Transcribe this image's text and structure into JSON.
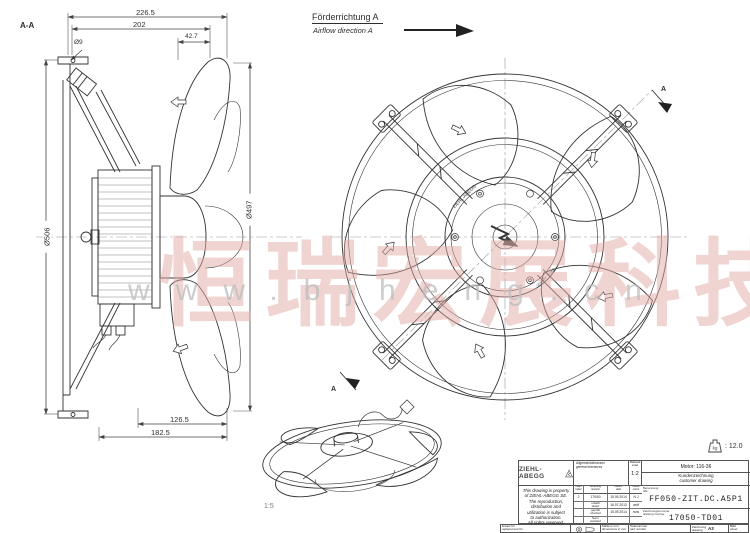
{
  "watermark": {
    "cn_text": "恒瑞宏展科技",
    "url_text": "www.bjheng.cn"
  },
  "annotations": {
    "section_label": "A-A",
    "airflow_de": "Förderrichtung A",
    "airflow_en": "Airflow direction A",
    "front_marker": "A",
    "iso_scale": "1:5",
    "hub_brand": "ZIEHL-ABEGG"
  },
  "dimensions": {
    "top_total": "226.5",
    "top_inner": "202",
    "top_small": "42.7",
    "hole": "Ø9",
    "outer_dia": "Ø506",
    "blade_dia": "Ø497",
    "bottom_inner": "126.5",
    "bottom_total": "182.5"
  },
  "titleblock": {
    "logo_text": "ZIEHL-ABEGG",
    "weight_text": ": 12.0",
    "weight_unit": "kg",
    "tolerances_de": "Allgemeintoleranzen",
    "tolerances_en": "general tolerances",
    "scale_de": "Maßstab",
    "scale_en": "scale",
    "scale_value": "1:2",
    "motor": "Motor: 116-36",
    "doc_type_de": "Kundenzeichnung",
    "doc_type_en": "customer drawing",
    "title_label_de": "Benennung",
    "title_label_en": "title",
    "part_name": "FF050-ZIT.DC.A5P1",
    "drawing_no_label_de": "Zeichnungsnummer",
    "drawing_no_label_en": "drawing number",
    "drawing_no": "17050-TD01",
    "notice_lines": [
      "This drawing is property",
      "of ZIEHL-ABEGG SE.",
      "The reproduction,",
      "distribution and",
      "utilization is subject",
      "to authorization.",
      "All rights reserved."
    ],
    "rev_table": {
      "headers": [
        {
          "de": "Index",
          "en": "index"
        },
        {
          "de": "Änderung",
          "en": "revision"
        },
        {
          "de": "Datum",
          "en": "date"
        },
        {
          "de": "Name",
          "en": "name"
        }
      ],
      "rows": [
        {
          "c0": "2",
          "c1_de": "175/00",
          "c1_en": "",
          "c2": "15.09.2014",
          "c3": "N.J"
        },
        {
          "c0": "",
          "c1_de": "erstellt",
          "c1_en": "drawn",
          "c2": "16.07.2013",
          "c3": "wolf"
        },
        {
          "c0": "",
          "c1_de": "geprüft",
          "c1_en": "checked",
          "c2": "15.09.2014",
          "c3": "rons"
        },
        {
          "c0": "",
          "c1_de": "Norm",
          "c1_en": "standard",
          "c2": "",
          "c3": ""
        }
      ]
    },
    "footer": {
      "replacement_de": "Ersatz für",
      "replacement_en": "replacement for",
      "units_de": "Maße in mm",
      "units_en": "dimensions in mm",
      "part_no_de": "Teilenummer",
      "part_no_en": "part number",
      "drawing_de": "Zeichnung",
      "drawing_en": "drawing",
      "format": "A3",
      "sheet_de": "Blatt",
      "sheet_en": "sheet"
    }
  }
}
